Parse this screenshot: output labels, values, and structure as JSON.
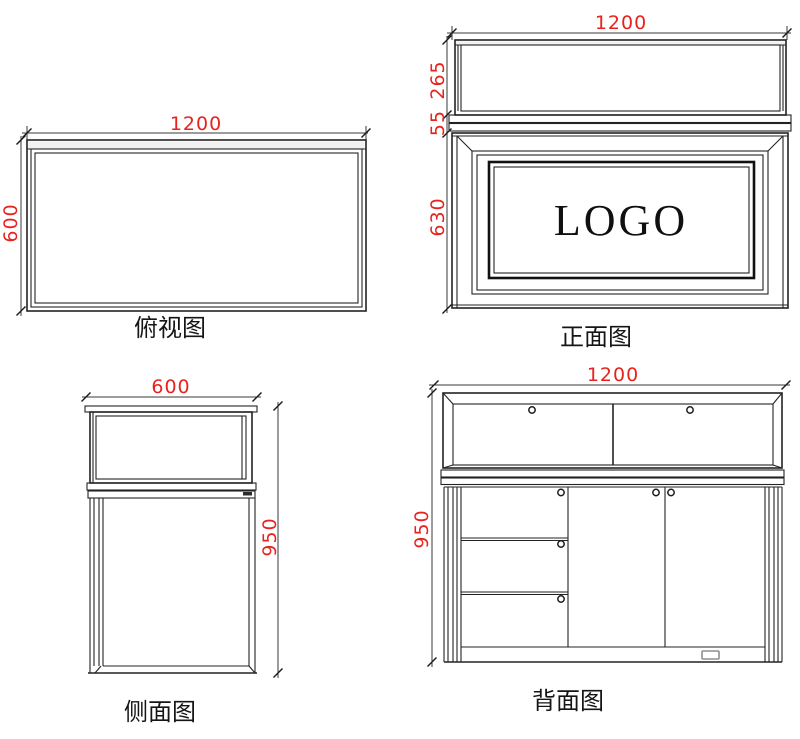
{
  "colors": {
    "line": "#232323",
    "dimension": "#e8231e"
  },
  "views": {
    "top": {
      "label": "俯视图",
      "dims": {
        "width": "1200",
        "depth": "600"
      }
    },
    "front": {
      "label": "正面图",
      "logo": "LOGO",
      "dims": {
        "width": "1200",
        "glass_height": "265",
        "counter_thickness": "55",
        "cabinet_height": "630"
      }
    },
    "side": {
      "label": "侧面图",
      "dims": {
        "depth": "600",
        "height": "950"
      }
    },
    "back": {
      "label": "背面图",
      "dims": {
        "width": "1200",
        "height": "950"
      }
    }
  }
}
